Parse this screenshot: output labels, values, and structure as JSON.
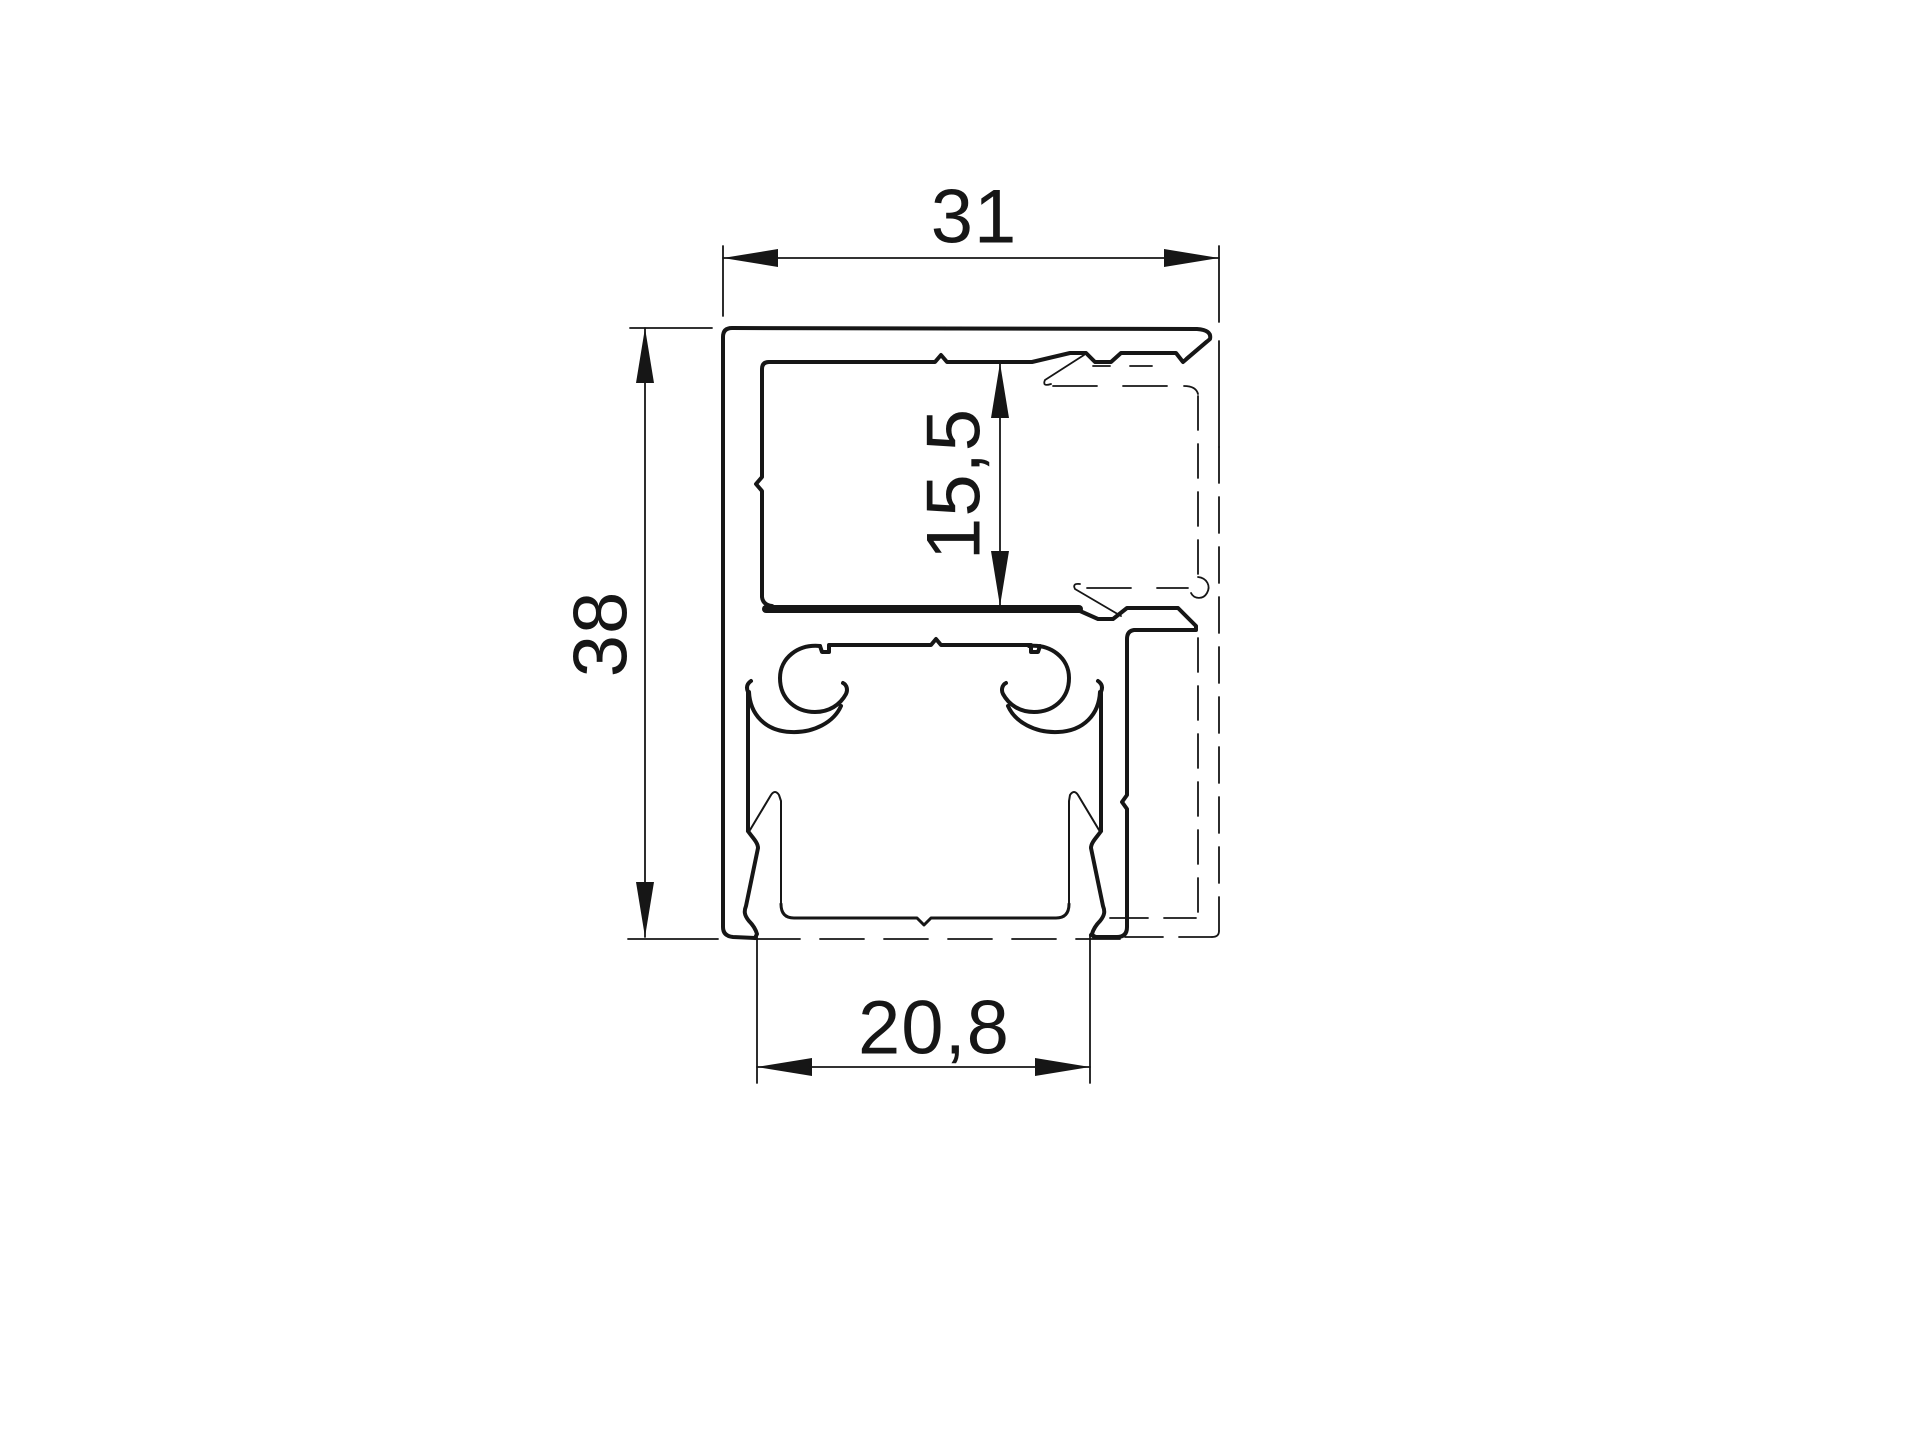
{
  "drawing": {
    "kind": "technical-cross-section",
    "background_color": "#ffffff",
    "line_color": "#161616",
    "dimensions": [
      {
        "id": "total-width",
        "label": "31",
        "value": 31,
        "unit": "mm",
        "orientation": "horizontal"
      },
      {
        "id": "total-height",
        "label": "38",
        "value": 38,
        "unit": "mm",
        "orientation": "vertical"
      },
      {
        "id": "chamber-height",
        "label": "15,5",
        "value": 15.5,
        "unit": "mm",
        "orientation": "vertical"
      },
      {
        "id": "channel-width",
        "label": "20,8",
        "value": 20.8,
        "unit": "mm",
        "orientation": "horizontal"
      }
    ]
  }
}
